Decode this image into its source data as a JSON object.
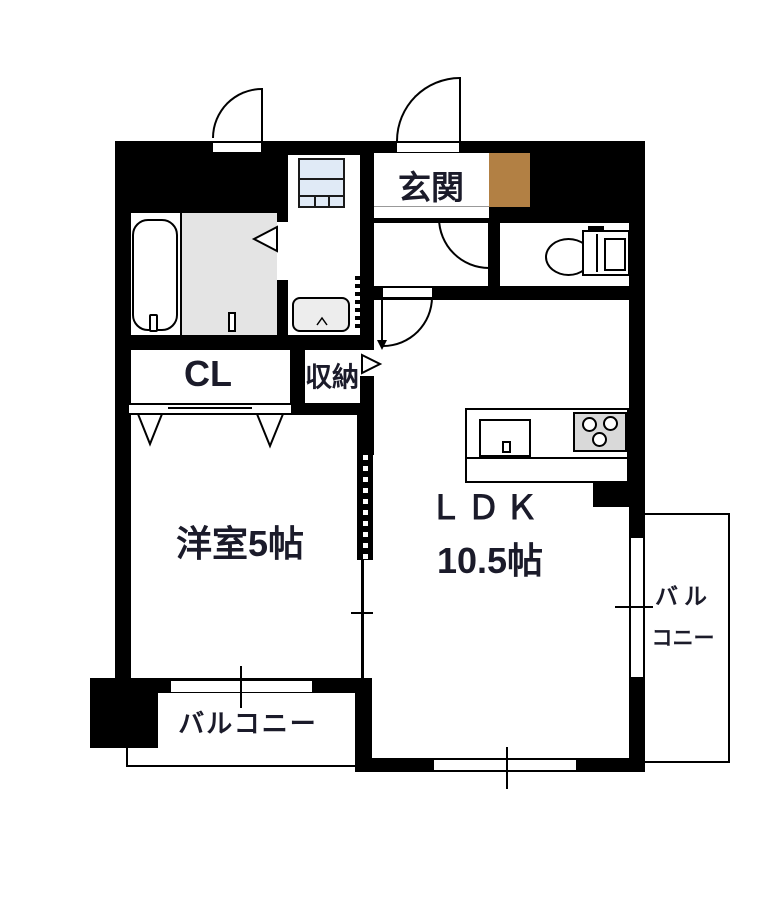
{
  "plan": {
    "labels": {
      "entrance": "玄関",
      "closet": "CL",
      "storage": "収納",
      "western_room": "洋室5帖",
      "ldk_name": "ＬＤＫ",
      "ldk_size": "10.5帖",
      "balcony_bottom": "バルコニー",
      "balcony_right_top": "バル",
      "balcony_right_bottom": "コニー"
    },
    "colors": {
      "wall": "#000000",
      "entrance_cabinet": "#b28044",
      "bath_floor": "#e4e4e4",
      "stove": "#d9d9d9",
      "vanity_fill": "#e0eaf6",
      "washer_pan": "#ededed",
      "label_text": "#1b1b2a"
    },
    "icons": [
      "bathtub-icon",
      "faucet-icon",
      "drain-icon",
      "vanity-icon",
      "washing-machine-pan-icon",
      "toilet-bowl-icon",
      "toilet-tank-icon",
      "kitchen-sink-icon",
      "stove-burners-icon",
      "door-swing-arc-icon",
      "bifold-door-icon",
      "sliding-door-dotted-icon",
      "door-triangle-icon",
      "window-icon"
    ]
  }
}
